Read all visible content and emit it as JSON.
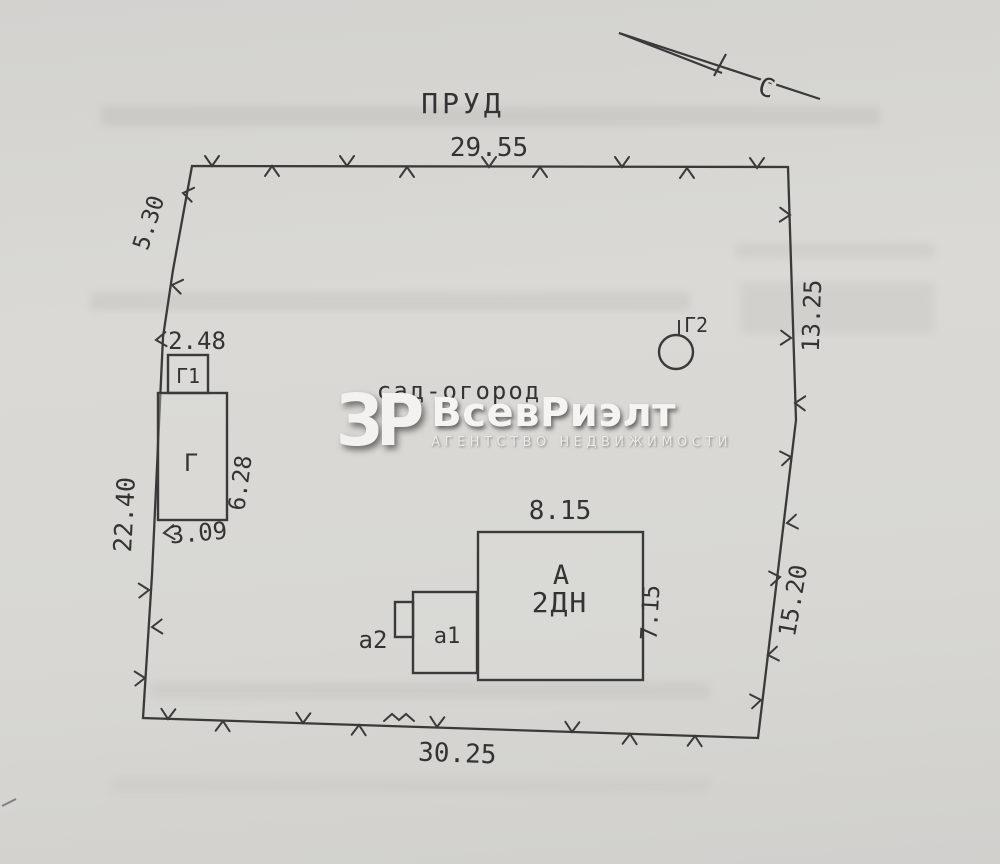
{
  "drawing": {
    "north_label": "С",
    "pond_label": "ПРУД",
    "garden_label": "сад-огород",
    "dim_top": "29.55",
    "dim_top_left": "5.30",
    "dim_left": "22.40",
    "dim_right_upper": "13.25",
    "dim_right_lower": "15.20",
    "dim_bottom": "30.25",
    "dim_shed_g1_width": "2.48",
    "dim_shed_g_height": "6.28",
    "dim_shed_g_width": "3.09",
    "dim_house_width": "8.15",
    "dim_house_height": "7.15",
    "label_shed_g1": "Г1",
    "label_shed_g": "Г",
    "label_well_g2": "Г2",
    "label_house_letter": "А",
    "label_house_type": "2ДН",
    "label_annex_a1": "а1",
    "label_annex_a2": "а2"
  },
  "watermark": {
    "logo": "ЗР",
    "title": "ВсевРиэлт",
    "subtitle": "АГЕНТСТВО НЕДВИЖИМОСТИ"
  },
  "colors": {
    "paper": "#d8d7d4",
    "ink": "#3a3a3a",
    "watermark_text": "#f5f4f2"
  }
}
